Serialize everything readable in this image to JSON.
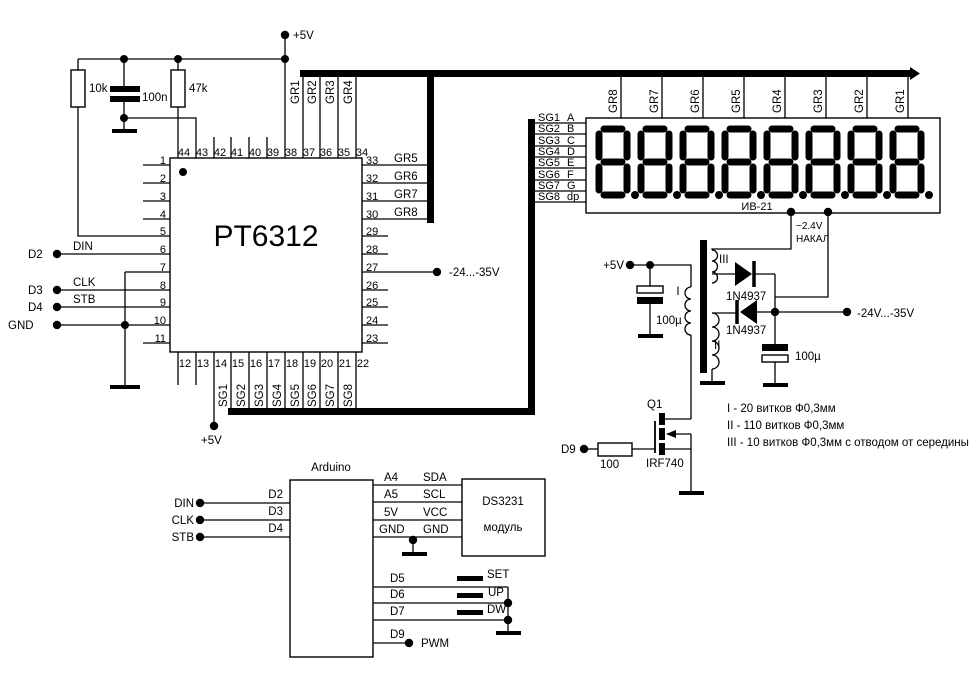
{
  "schematic": {
    "chip": {
      "name": "PT6312",
      "pins_top": [
        "44",
        "43",
        "42",
        "41",
        "40",
        "39",
        "38",
        "37",
        "36",
        "35",
        "34"
      ],
      "pins_left": [
        "1",
        "2",
        "3",
        "4",
        "5",
        "6",
        "7",
        "8",
        "9",
        "10",
        "11"
      ],
      "pins_right": [
        "33",
        "32",
        "31",
        "30",
        "29",
        "28",
        "27",
        "26",
        "25",
        "24",
        "23"
      ],
      "pins_bottom": [
        "12",
        "13",
        "14",
        "15",
        "16",
        "17",
        "18",
        "19",
        "20",
        "21",
        "22"
      ],
      "grids_top": [
        "GR1",
        "GR2",
        "GR3",
        "GR4"
      ],
      "grids_right": [
        "GR5",
        "GR6",
        "GR7",
        "GR8"
      ],
      "segments_bottom": [
        "SG1",
        "SG2",
        "SG3",
        "SG4",
        "SG5",
        "SG6",
        "SG7",
        "SG8"
      ]
    },
    "nets": {
      "d2": "D2",
      "din": "DIN",
      "d3": "D3",
      "clk": "CLK",
      "d4": "D4",
      "stb": "STB",
      "gnd": "GND",
      "neg_supply": "-24...-35V",
      "plus5_top": "+5V",
      "plus5_pin14": "+5V"
    },
    "passives": {
      "r1": "10k",
      "c1": "100n",
      "r2": "47k"
    },
    "display": {
      "name": "ИВ-21",
      "grids": [
        "GR8",
        "GR7",
        "GR6",
        "GR5",
        "GR4",
        "GR3",
        "GR2",
        "GR1"
      ],
      "seg_pins": [
        "SG1",
        "SG2",
        "SG3",
        "SG4",
        "SG5",
        "SG6",
        "SG7",
        "SG8"
      ],
      "seg_names": [
        "A",
        "B",
        "C",
        "D",
        "E",
        "F",
        "G",
        "dp"
      ],
      "digits": [
        "8.",
        "8.",
        "8.",
        "8.",
        "8.",
        "8.",
        "8.",
        "8."
      ],
      "filament_voltage": "~2.4V",
      "filament_label": "НАКАЛ"
    },
    "psu": {
      "supply": "+5V",
      "cap_in": "100µ",
      "cap_out": "100µ",
      "diode_top": "1N4937",
      "diode_bottom": "1N4937",
      "winding_primary": "I",
      "winding_secondary": "II",
      "winding_filament": "III",
      "transistor_ref": "Q1",
      "transistor_part": "IRF740",
      "gate_resistor": "100",
      "gate_net": "D9",
      "output": "-24V...-35V",
      "notes": [
        "I - 20 витков Ф0,3мм",
        "II - 110 витков Ф0,3мм",
        "III - 10 витков Ф0,3мм с отводом от середины"
      ]
    },
    "arduino": {
      "name": "Arduino",
      "left": [
        {
          "net": "DIN",
          "pin": "D2"
        },
        {
          "net": "CLK",
          "pin": "D3"
        },
        {
          "net": "STB",
          "pin": "D4"
        }
      ],
      "i2c": [
        {
          "pin": "A4",
          "net": "SDA"
        },
        {
          "pin": "A5",
          "net": "SCL"
        },
        {
          "pin": "5V",
          "net": "VCC"
        },
        {
          "pin": "GND",
          "net": "GND"
        }
      ],
      "module": {
        "name": "DS3231",
        "type": "модуль"
      },
      "buttons": [
        {
          "pin": "D5",
          "label": "SET"
        },
        {
          "pin": "D6",
          "label": "UP"
        },
        {
          "pin": "D7",
          "label": "DW"
        }
      ],
      "pwm": {
        "pin": "D9",
        "label": "PWM"
      }
    }
  }
}
